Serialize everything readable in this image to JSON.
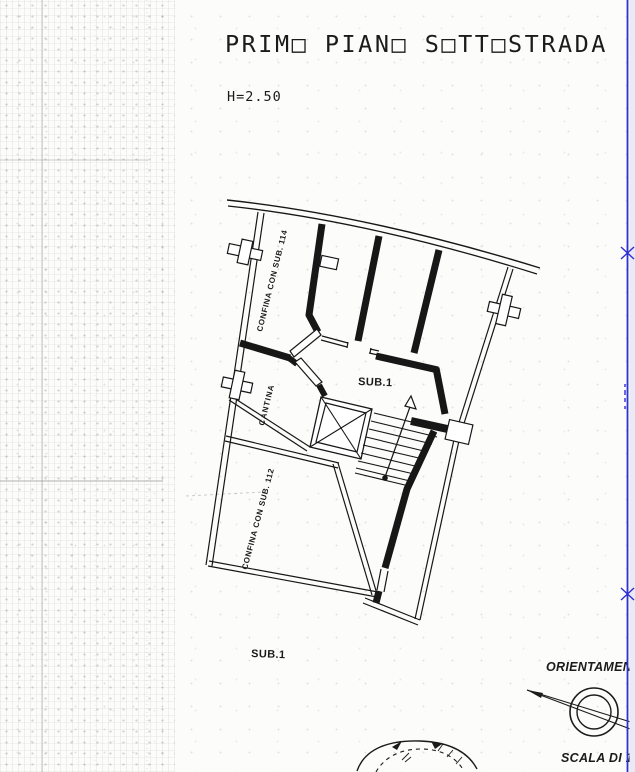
{
  "page": {
    "title": "PRIM□ PIAN□ S□TT□STRADA",
    "height_note": "H=2.50"
  },
  "plan": {
    "labels": {
      "confina_sub_114": "CONFINA CON SUB. 114",
      "cantina": "CANTINA",
      "sub1": "SUB.1",
      "confina_sub_112": "CONFINA CON SUB. 112",
      "sub1_lower": "SUB.1"
    }
  },
  "footer": {
    "orientation": "ORIENTAMENTO",
    "scale_prefix": "SCALA DI 1:",
    "scale_value": "100"
  },
  "colors": {
    "ink": "#1b1b1b",
    "annotation_blue": "#2f2fd4"
  }
}
